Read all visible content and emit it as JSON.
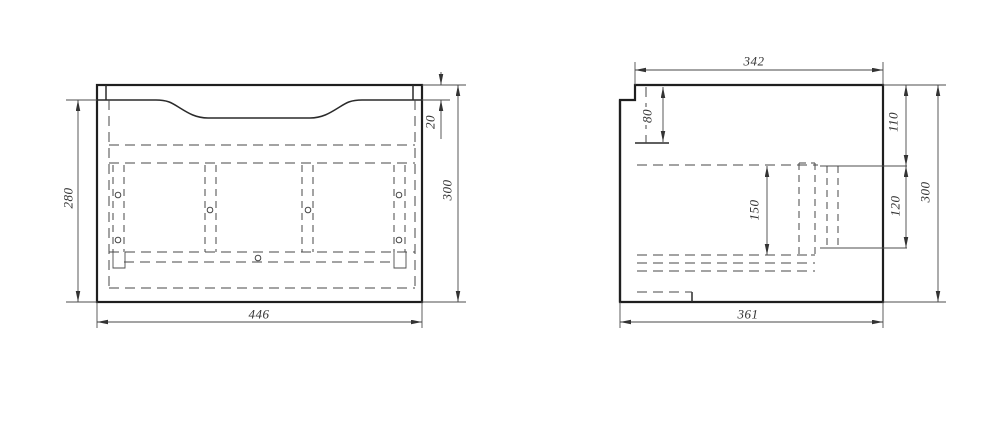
{
  "page": {
    "background": "#ffffff",
    "line_color": "#2a2a2a",
    "kind": "furniture cabinet technical drawing, two orthographic views"
  },
  "front_view": {
    "name": "front-view",
    "dimensions": {
      "width": "446",
      "height_left": "280",
      "height_right": "300",
      "top_rail": "20"
    }
  },
  "side_view": {
    "name": "side-view",
    "dimensions": {
      "width_top": "342",
      "width_bottom": "361",
      "height": "300",
      "upper_segment": "110",
      "middle_segment": "120",
      "notch_height": "80",
      "inner_height": "150"
    }
  }
}
